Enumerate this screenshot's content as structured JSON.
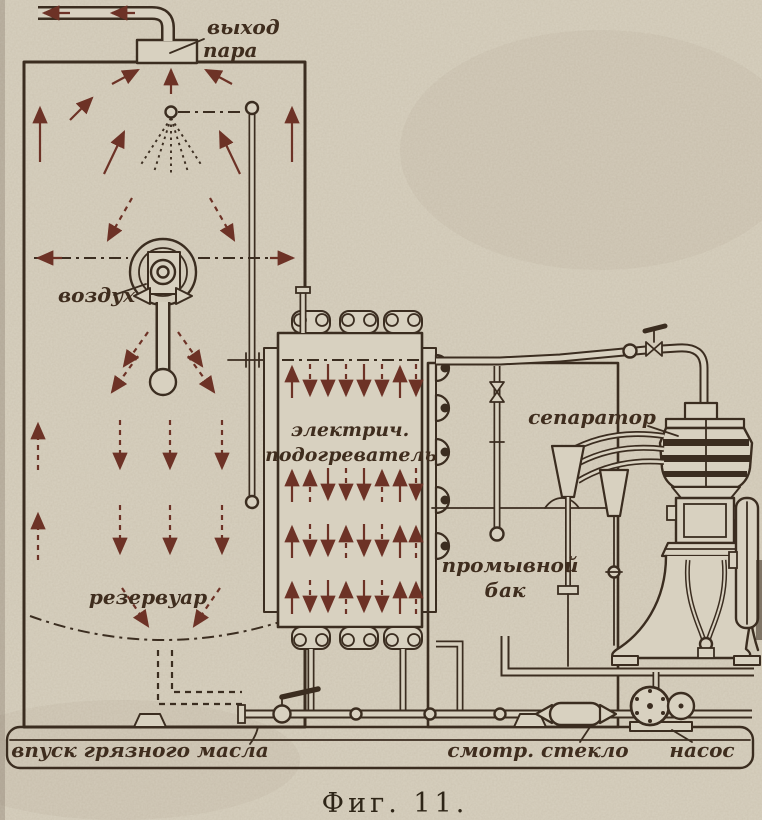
{
  "figure": {
    "caption": "Фиг. 11."
  },
  "labels": {
    "steam_outlet": {
      "line1": "выход",
      "line2": "пара"
    },
    "air": "воздух",
    "reservoir": "резервуар",
    "electric_heater": {
      "line1": "электрич.",
      "line2": "подогреватель"
    },
    "separator": "сепаратор",
    "wash_tank": {
      "line1": "промывной",
      "line2": "бак"
    },
    "dirty_oil_inlet": "впуск грязного масла",
    "sight_glass": "смотр. стекло",
    "pump": "насос"
  },
  "colors": {
    "paper": "#d8d1c0",
    "ink": "#3b2d20",
    "arrow": "#6d3226",
    "label": "#3f2d1e",
    "caption": "#2e2517"
  }
}
